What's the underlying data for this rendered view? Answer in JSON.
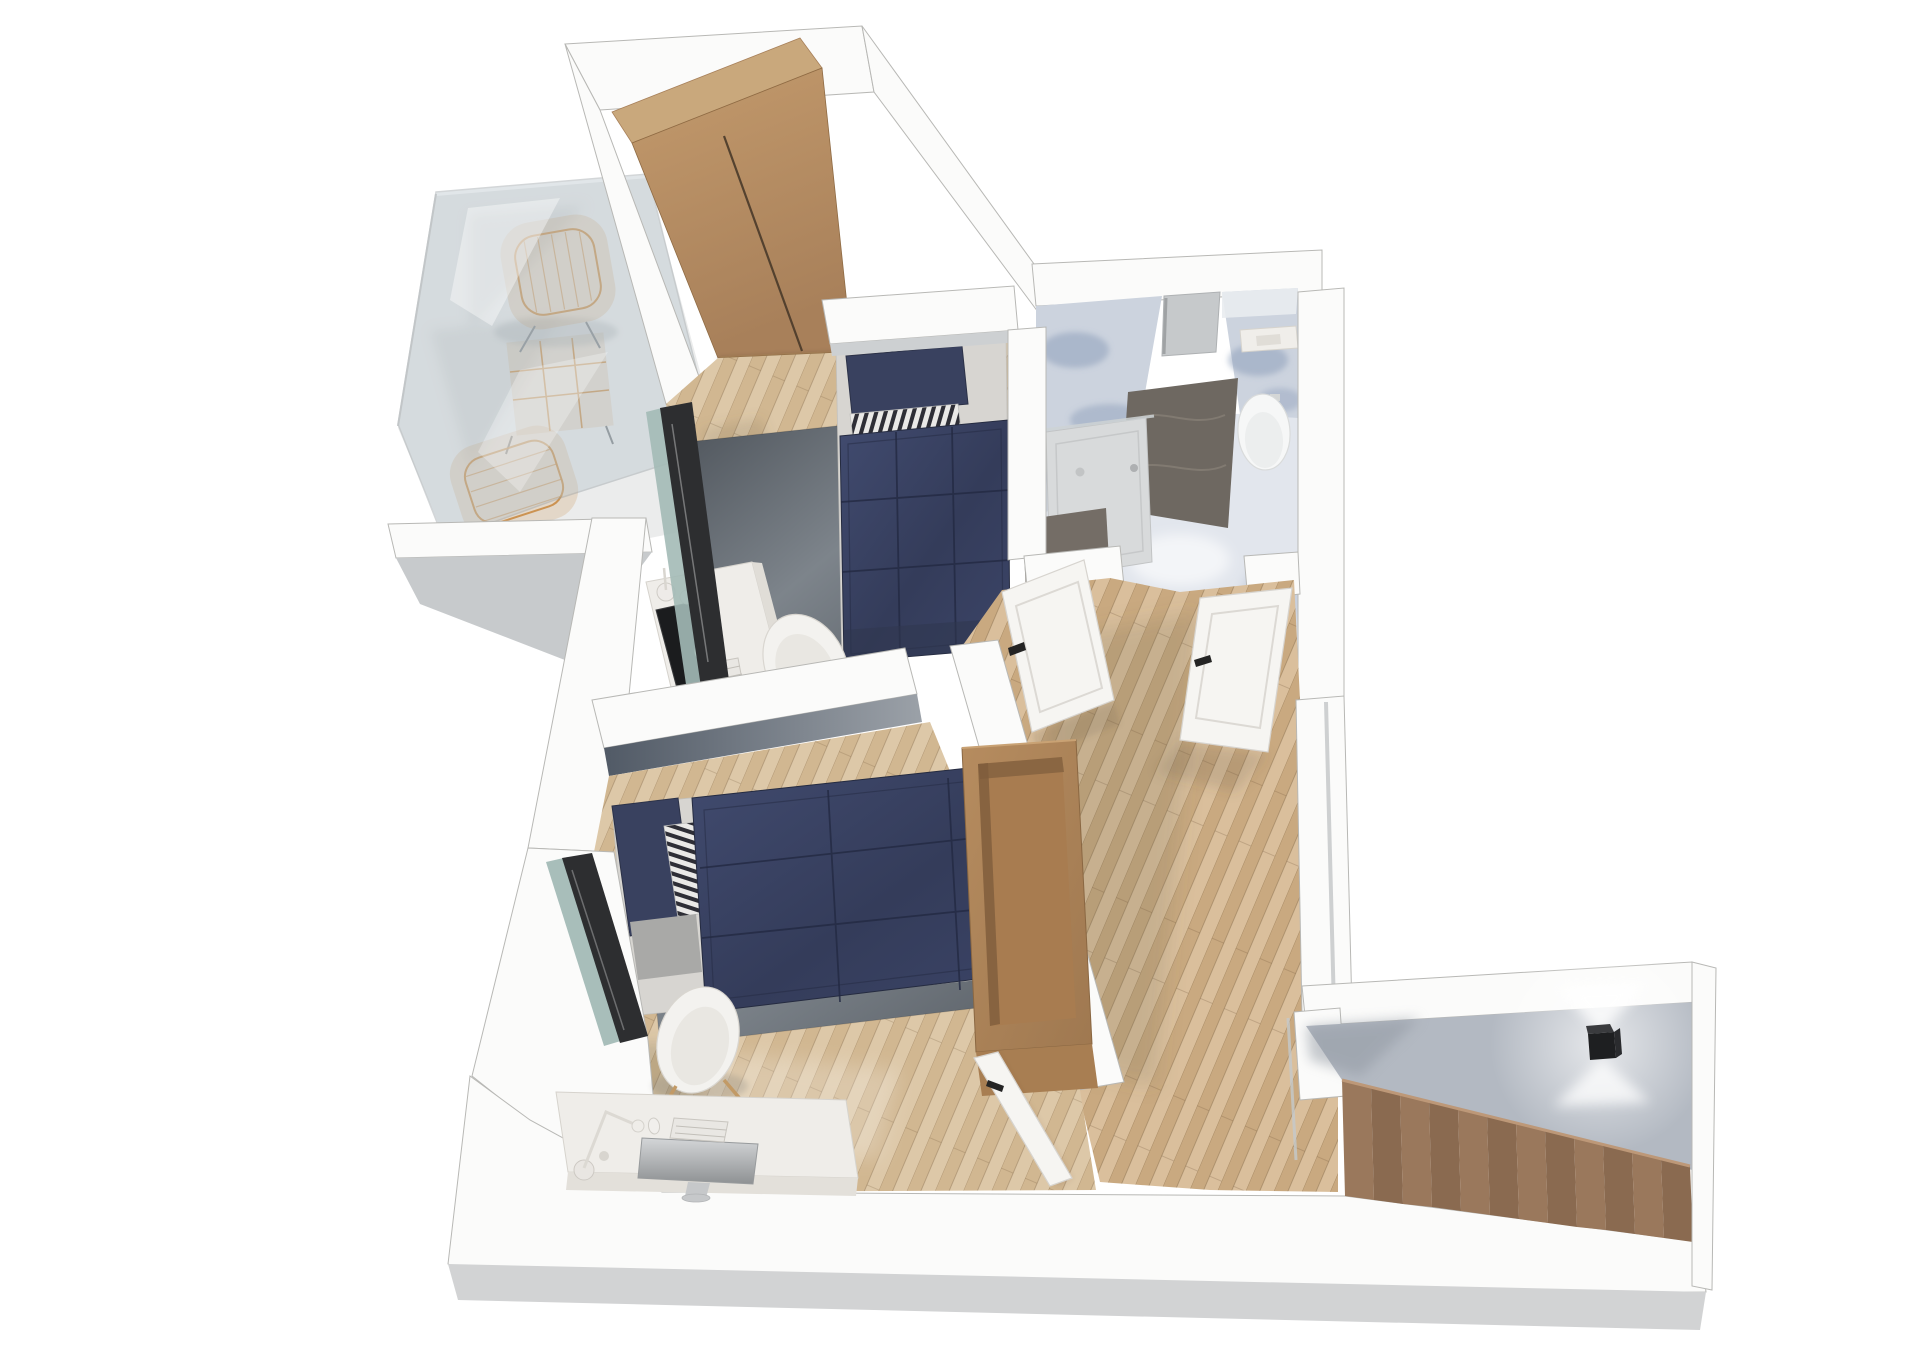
{
  "meta": {
    "title": "Upper-floor 3D dollhouse floor plan render",
    "view": "top-down cutaway axonometric render, white background, no visible text"
  },
  "palette": {
    "bg": "#ffffff",
    "wall_white": "#fbfbfa",
    "wall_edge": "#b8b8b5",
    "wall_gray_face": "#c7cacc",
    "wall_bottom_face": "#d2d3d4",
    "stair_wall": "#b3b9c2",
    "balcony_floor": "#ebecec",
    "balcony_shadow": "#c7c9c9",
    "glass": "#b9c5cc",
    "glass_teal": "#a3bab6",
    "frame_dark": "#2d2e30",
    "wood_furniture": "#b88e61",
    "wood_top": "#c9a87c",
    "wood_seam": "#4a3a2a",
    "cabinet_cavity": "#a87c50",
    "floor_wood": "#d8c2a1",
    "hall_wood": "#d2b690",
    "stairs_wood": "#9a785c",
    "stairs_wood_dark": "#8a6a50",
    "stairs_highlight": "#bd9878",
    "duvet_navy": "#39415f",
    "duvet_seam": "#232942",
    "pillow_navy": "#39415f",
    "stripe_light": "#eae9e7",
    "stripe_dark": "#2e2e36",
    "mattress": "#d7d5d1",
    "bed_base_gray": "#a9a9a7",
    "rug_dark": "#4d535a",
    "chair_white": "#f3f2ef",
    "chair_leg_wood": "#c29a66",
    "desk_white": "#efede9",
    "monitor_black": "#1b1c1e",
    "device_gray": "#c6c8ca",
    "marble_base": "#ccd3de",
    "marble_floor": "#e2e6ed",
    "marble_blot": "#8a9cb8",
    "dark_marble": "#6e6861",
    "dark_marble_vanity": "#746d66",
    "shower_tray": "#d8dadb",
    "fixture_white": "#f6f7f7",
    "copper": "#b06a42",
    "rattan": "#c8873d",
    "door_white": "#f6f5f2",
    "door_panel_line": "#dcd9d4",
    "handle_black": "#242424",
    "lamp_black": "#1e1f21",
    "niche_gray": "#c6c9cb"
  },
  "scene": {
    "rooms": [
      {
        "id": "balcony",
        "label": "Balcony",
        "items": [
          "rattan armchair",
          "rattan armchair",
          "rattan side table",
          "glass balustrade"
        ]
      },
      {
        "id": "bedroom-1",
        "label": "Bedroom 1",
        "items": [
          "two-door wood wardrobe",
          "single bed, navy duvet",
          "navy pillow",
          "striped accent pillow",
          "dark area rug",
          "desk with monitor, keyboard, mouse, lamp",
          "white shell chair",
          "sliding glass door to balcony",
          "white interior door"
        ]
      },
      {
        "id": "bathroom",
        "label": "Bathroom",
        "items": [
          "walk-in shower with glass",
          "dark stone shower wall",
          "wall niche",
          "wall-hung toilet",
          "flush plate",
          "round basin on stone vanity",
          "copper faucet",
          "blue-grey marble walls and floor",
          "white interior door"
        ]
      },
      {
        "id": "bedroom-2",
        "label": "Bedroom 2",
        "items": [
          "single bed, navy duvet",
          "navy pillow",
          "striped accent pillow",
          "dark area rug",
          "open wooden storage unit",
          "desk with all-in-one computer, keyboard, mouse, lamp",
          "white shell chair",
          "window",
          "white interior door"
        ]
      },
      {
        "id": "hallway",
        "label": "Hallway landing",
        "items": [
          "wood plank floor"
        ]
      },
      {
        "id": "staircase",
        "label": "Staircase",
        "items": [
          "12 descending wood steps",
          "black cube wall light"
        ]
      }
    ],
    "counts": {
      "beds": 2,
      "desks": 2,
      "desk_chairs": 2,
      "rattan_chairs": 2,
      "doors": 3,
      "steps": 12,
      "toilets": 1,
      "basins": 1,
      "wall_lights": 1
    }
  }
}
